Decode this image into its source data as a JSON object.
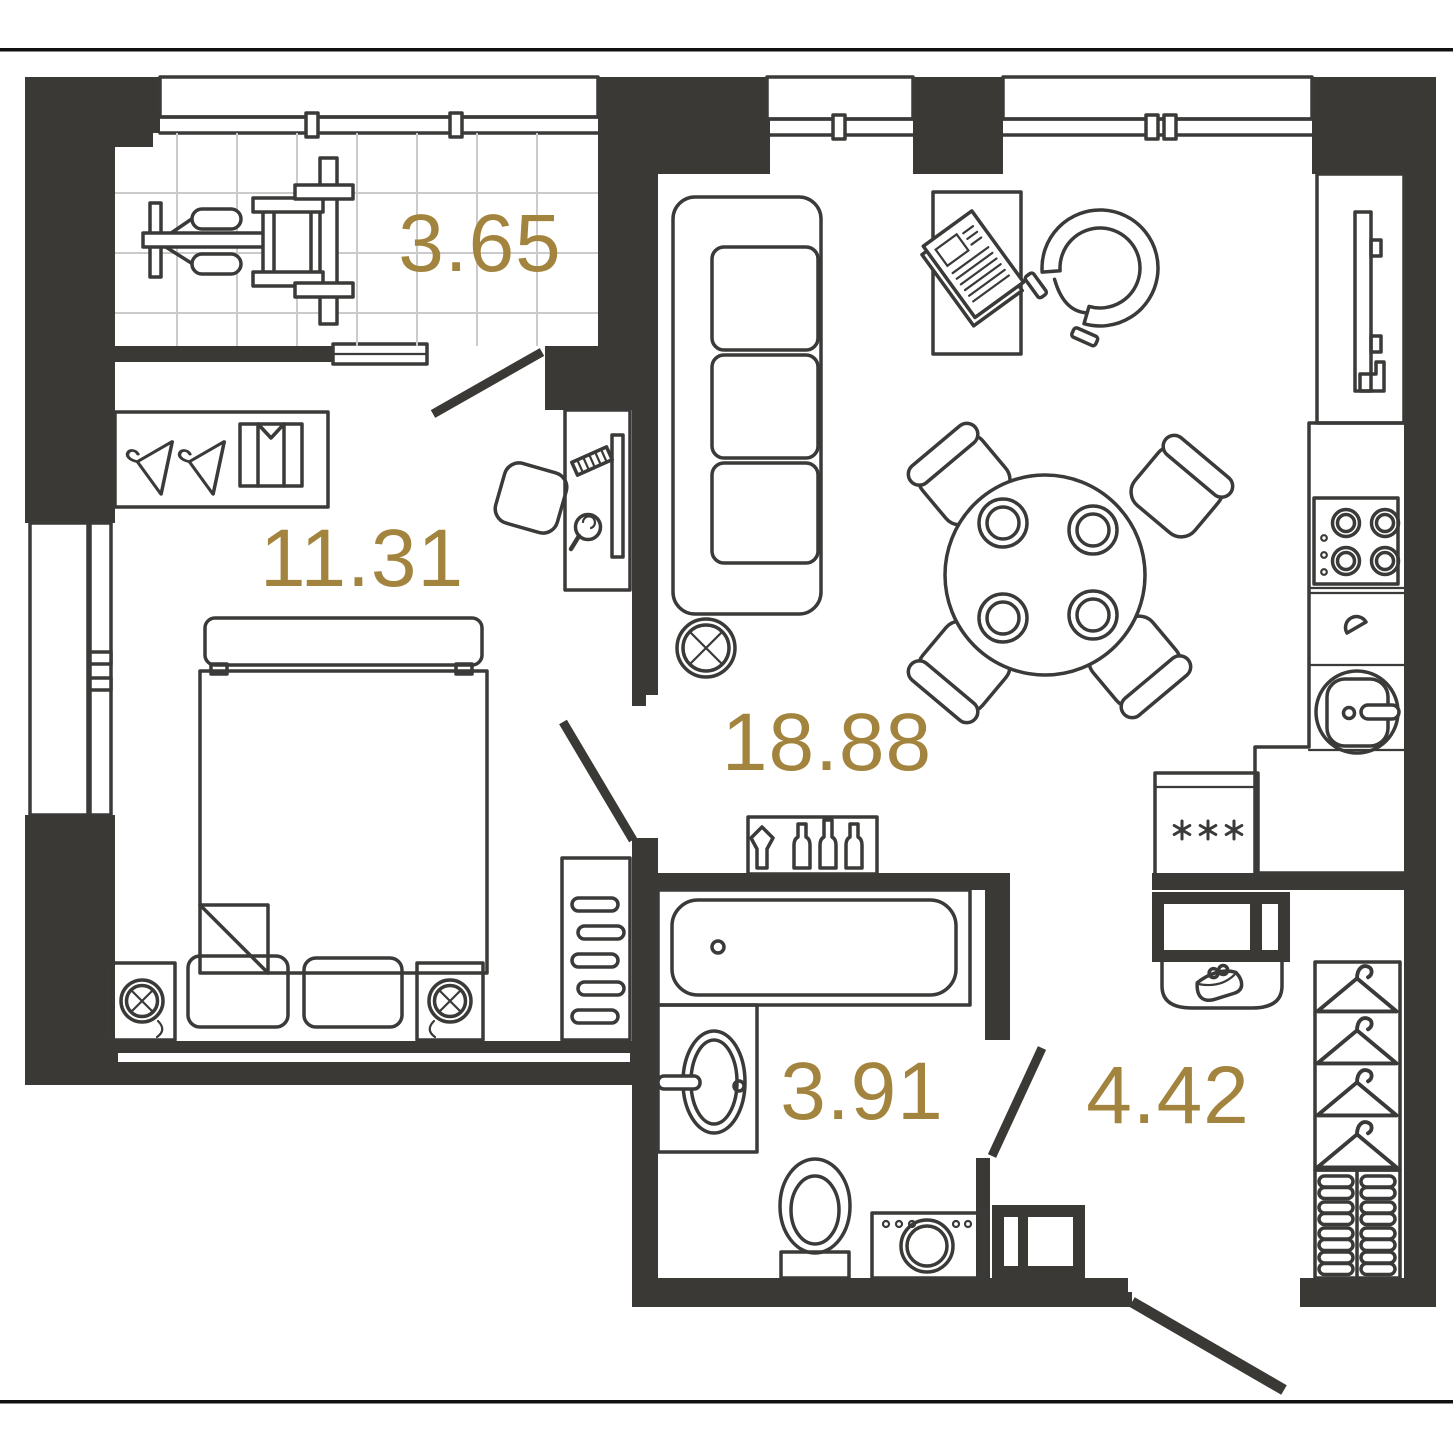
{
  "plan_type": "apartment-floor-plan",
  "rooms": [
    {
      "id": "balcony",
      "area_label": "3.65"
    },
    {
      "id": "bedroom",
      "area_label": "11.31"
    },
    {
      "id": "living-kitchen",
      "area_label": "18.88"
    },
    {
      "id": "bathroom",
      "area_label": "3.91"
    },
    {
      "id": "hallway",
      "area_label": "4.42"
    }
  ],
  "colors": {
    "wall": "#3b3936",
    "line": "#3a3a38",
    "accent": "#a3843e",
    "tile": "#cbcbcb",
    "rule": "#101010",
    "background": "#ffffff"
  },
  "icons": {
    "exercise-bike-icon": "svg-shape",
    "hanger-icon": "svg-shape",
    "folded-shirt-icon": "svg-shape",
    "desk-icon": "svg-shape",
    "monitor-icon": "svg-shape",
    "keyboard-icon": "svg-shape",
    "mouse-icon": "svg-shape",
    "desk-chair-icon": "svg-shape",
    "double-bed-icon": "svg-shape",
    "pillow-icon": "svg-shape",
    "nightstand-lamp-icon": "svg-shape",
    "radiator-icon": "svg-shape",
    "sofa-icon": "svg-shape",
    "coffee-table-icon": "svg-shape",
    "newspaper-icon": "svg-shape",
    "armchair-icon": "svg-shape",
    "dining-table-icon": "svg-shape",
    "plate-icon": "svg-shape",
    "dining-chair-icon": "svg-shape",
    "ceiling-lamp-icon": "svg-shape",
    "bottle-shelf-icon": "svg-shape",
    "fridge-icon": "svg-shape",
    "tv-icon": "svg-shape",
    "hob-icon": "svg-shape",
    "kitchen-sink-icon": "svg-shape",
    "bathtub-icon": "svg-shape",
    "washbasin-icon": "svg-shape",
    "toilet-icon": "svg-shape",
    "washing-machine-icon": "svg-shape",
    "storage-niche-icon": "svg-shape",
    "console-purse-icon": "svg-shape",
    "wardrobe-icon": "svg-shape",
    "shoe-shelf-icon": "svg-shape",
    "window-icon": "svg-shape",
    "door-leaf-icon": "svg-shape"
  }
}
